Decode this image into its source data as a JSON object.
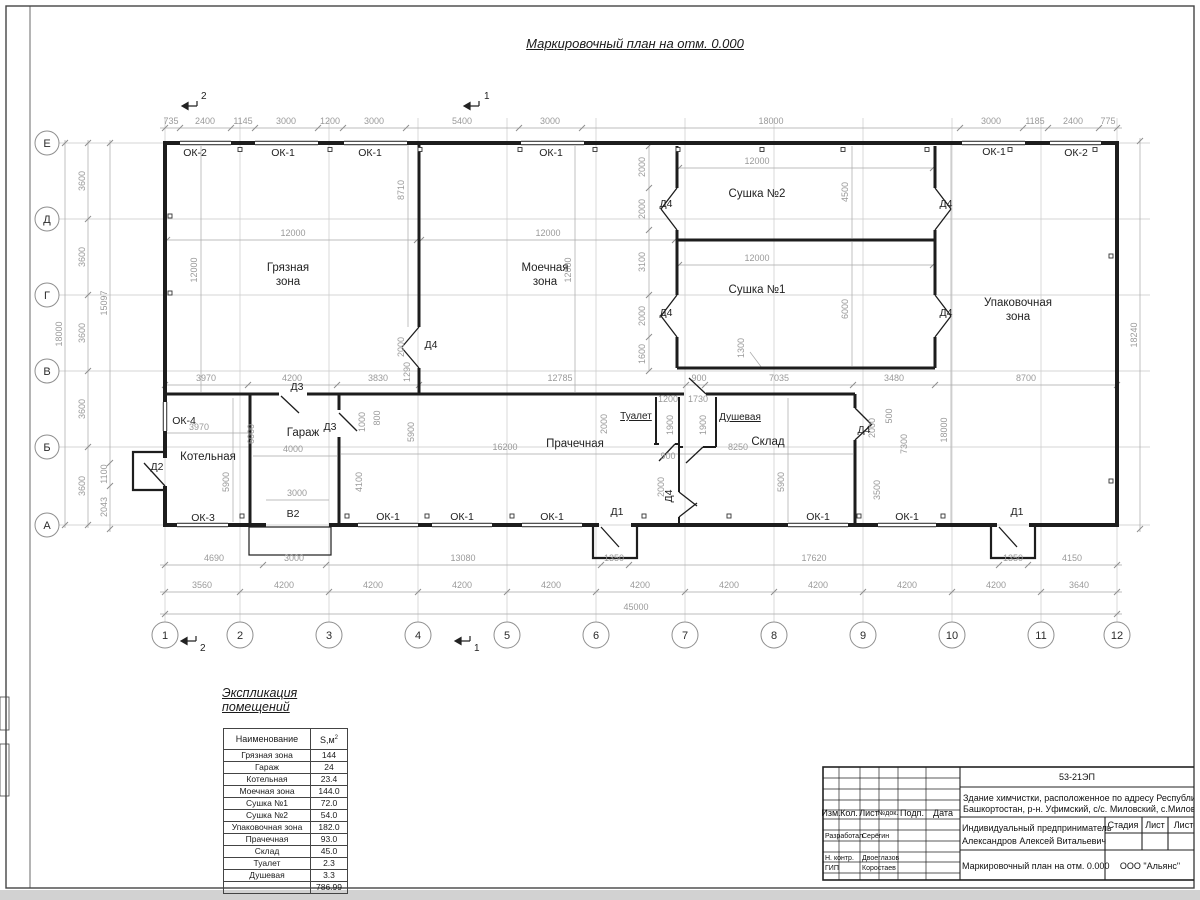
{
  "title": "Маркировочный план на отм. 0.000",
  "colors": {
    "wall": "#1d1d1d",
    "dim_text": "#9a9a9a",
    "axis_line": "#c0c0c0"
  },
  "axes": {
    "rows": [
      "Е",
      "Д",
      "Г",
      "В",
      "Б",
      "А"
    ],
    "cols": [
      "1",
      "2",
      "3",
      "4",
      "5",
      "6",
      "7",
      "8",
      "9",
      "10",
      "11",
      "12"
    ]
  },
  "sections": {
    "s1": "1",
    "s2": "2"
  },
  "rooms": {
    "dirty1": "Грязная",
    "dirty2": "зона",
    "wash1": "Моечная",
    "wash2": "зона",
    "dry2": "Сушка №2",
    "dry1": "Сушка №1",
    "pack1": "Упаковочная",
    "pack2": "зона",
    "boiler": "Котельная",
    "garage": "Гараж",
    "laundry": "Прачечная",
    "storage": "Склад",
    "toilet": "Туалет",
    "shower": "Душевая"
  },
  "openings": {
    "top": [
      "ОК-2",
      "ОК-1",
      "ОК-1",
      "ОК-1",
      "ОК-1",
      "ОК-2"
    ],
    "bottom": [
      "ОК-3",
      "ОК-1",
      "ОК-1",
      "ОК-1",
      "ОК-1",
      "ОК-1"
    ],
    "ok4": "ОК-4",
    "d1": "Д1",
    "d2": "Д2",
    "d3": "Д3",
    "d4": "Д4",
    "v2": "В2"
  },
  "dims": {
    "top": [
      "735",
      "2400",
      "1145",
      "3000",
      "1200",
      "3000",
      "5400",
      "3000",
      "18000",
      "3000",
      "1185",
      "2400",
      "775"
    ],
    "bottom1": [
      "4690",
      "3000",
      "13080",
      "1350",
      "17620",
      "1350",
      "4150"
    ],
    "bottom2": [
      "3560",
      "4200",
      "4200",
      "4200",
      "4200",
      "4200",
      "4200",
      "4200",
      "4200",
      "4200",
      "3640"
    ],
    "total_w": "45000",
    "left": {
      "total": "18000",
      "segs": [
        "3600",
        "3600",
        "3600",
        "3600",
        "3600"
      ],
      "partial": "15097",
      "p1100": "1100",
      "p2043": "2043"
    },
    "right": "18240",
    "mid": [
      "3970",
      "4200",
      "3830",
      "12785",
      "900",
      "7035",
      "3480",
      "8700"
    ],
    "inner": {
      "dirty_w": "12000",
      "dirty_h": "12000",
      "dirty_r": "8710",
      "dirty_door": "2000",
      "d1290": "1290",
      "wash_w": "12000",
      "wash_h": "12000",
      "wash_r": [
        "2000",
        "2000",
        "3100",
        "2000",
        "1600"
      ],
      "dry2_w": "12000",
      "dry2_h": "4500",
      "dry1_w": "12000",
      "dry1_h": "6000",
      "dry_pass": "1300",
      "pack_v": "18000",
      "boiler_w": "3970",
      "boiler_h": "5900",
      "boiler_r": "6000",
      "garage_w": "4000",
      "garage_gate": "3000",
      "garage_r": "4100",
      "g1000": "1000",
      "g800": "800",
      "laundry_l": "5900",
      "laundry_w": "16200",
      "t2000": "2000",
      "toilet_w": "1200",
      "shower_w": "1730",
      "toilet_h": "1900",
      "shower_h": "1900",
      "storage_w": "8250",
      "corridor": "900",
      "cor2000": "2000",
      "storage_r": "5900",
      "sk2000": "2000",
      "sk500": "500",
      "sk7300": "7300",
      "sk3500": "3500"
    }
  },
  "legend": {
    "title": "Экспликация помещений",
    "col1": "Наименование",
    "col2": "S,м",
    "col2_sup": "2",
    "rows": [
      [
        "Грязная зона",
        "144"
      ],
      [
        "Гараж",
        "24"
      ],
      [
        "Котельная",
        "23.4"
      ],
      [
        "Моечная зона",
        "144.0"
      ],
      [
        "Сушка №1",
        "72.0"
      ],
      [
        "Сушка №2",
        "54.0"
      ],
      [
        "Упаковочная зона",
        "182.0"
      ],
      [
        "Прачечная",
        "93.0"
      ],
      [
        "Склад",
        "45.0"
      ],
      [
        "Туалет",
        "2.3"
      ],
      [
        "Душевая",
        "3.3"
      ]
    ],
    "total": "786.99"
  },
  "stamp": {
    "code": "53-21ЭП",
    "object1": "Здание химчистки,  расположенное по адресу Республи",
    "object2": "Башкортостан, р-н. Уфимский, с/с. Миловский, с.Милов",
    "cols": [
      "Изм.",
      "Кол.",
      "Лист",
      "№док.",
      "Подп.",
      "Дата"
    ],
    "roles": [
      [
        "Разработал",
        "Серёгин"
      ],
      [
        "Н. контр.",
        "Двоеглазов"
      ],
      [
        "ГИП",
        "Коростаев"
      ]
    ],
    "client1": "Индивидуальный предприниматель",
    "client2": "Александров Алексей Витальевич",
    "stage_cols": [
      "Стадия",
      "Лист",
      "Листо"
    ],
    "doc": "Маркировочный план на отм. 0.000",
    "org": "ООО \"Альянс\""
  }
}
